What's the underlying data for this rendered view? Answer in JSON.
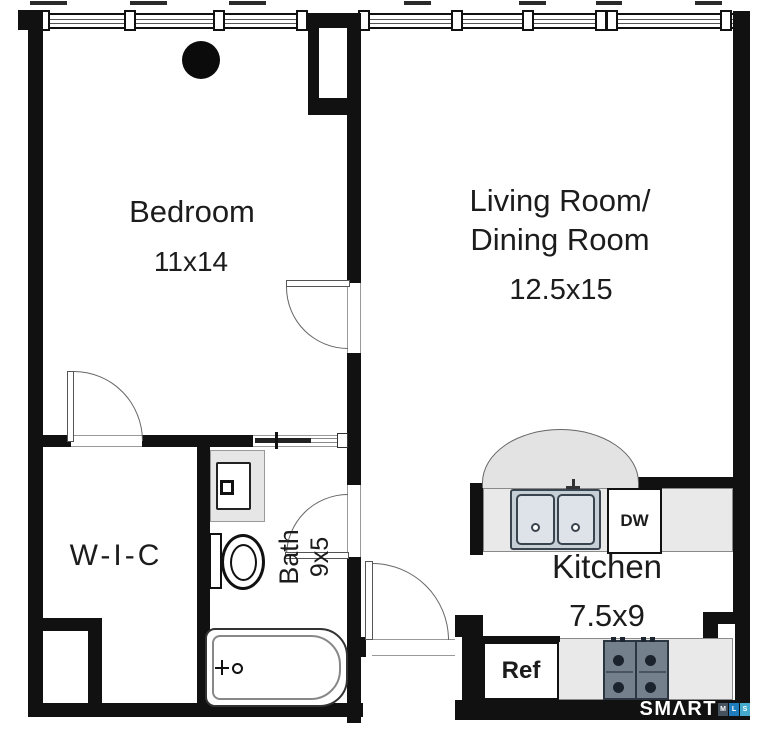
{
  "plan": {
    "rooms": {
      "bedroom": {
        "name": "Bedroom",
        "dims": "11x14"
      },
      "living": {
        "name_line1": "Living Room/",
        "name_line2": "Dining Room",
        "dims": "12.5x15"
      },
      "wic": {
        "name": "W-I-C"
      },
      "bath": {
        "name": "Bath",
        "dims": "9x5"
      },
      "kitchen": {
        "name": "Kitchen",
        "dims": "7.5x9"
      }
    },
    "fixtures": {
      "dishwasher_label": "DW",
      "refrigerator_label": "Ref"
    },
    "logo": {
      "brand_display": "SMΛRT",
      "badges": [
        {
          "letter": "M",
          "color": "#46525e"
        },
        {
          "letter": "L",
          "color": "#1f7dbd"
        },
        {
          "letter": "S",
          "color": "#44aacd"
        }
      ]
    },
    "colors": {
      "wall": "#111111",
      "counter": "#e9e9e9",
      "arch": "#e3e3e3",
      "stove": "#75808d",
      "text": "#1c1c1c"
    }
  }
}
